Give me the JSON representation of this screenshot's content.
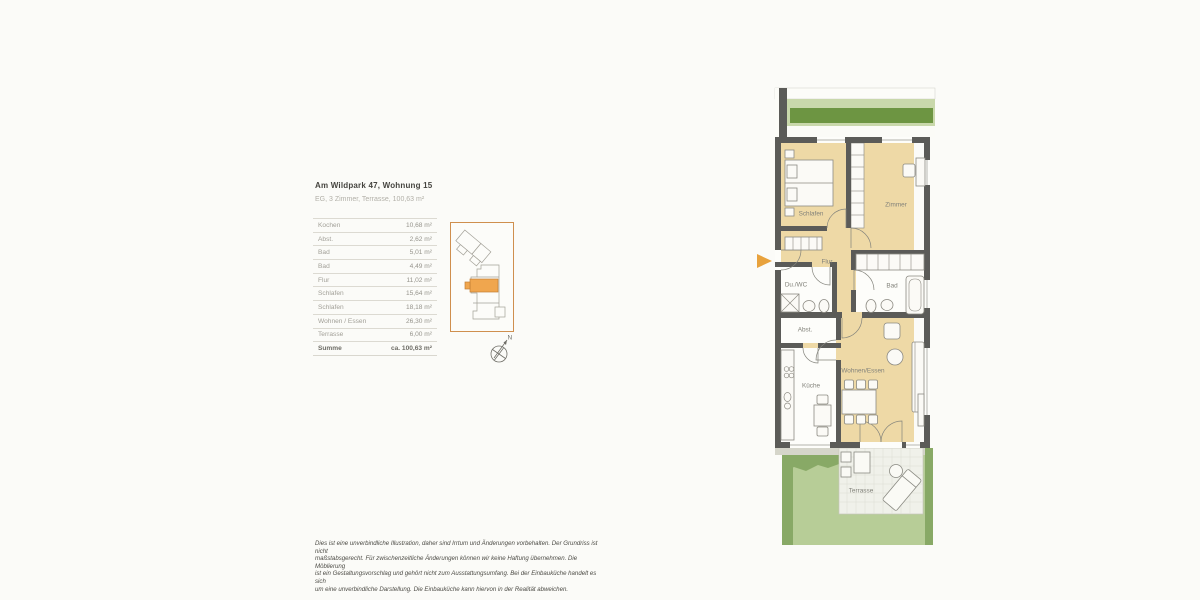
{
  "header": {
    "title": "Am Wildpark 47, Wohnung 15",
    "subtitle": "EG, 3 Zimmer, Terrasse, 100,63 m²"
  },
  "area_table": {
    "rows": [
      {
        "label": "Kochen",
        "value": "10,68 m²",
        "bold": false
      },
      {
        "label": "Abst.",
        "value": "2,62 m²",
        "bold": false
      },
      {
        "label": "Bad",
        "value": "5,01 m²",
        "bold": false
      },
      {
        "label": "Bad",
        "value": "4,49 m²",
        "bold": false
      },
      {
        "label": "Flur",
        "value": "11,02 m²",
        "bold": false
      },
      {
        "label": "Schlafen",
        "value": "15,64 m²",
        "bold": false
      },
      {
        "label": "Schlafen",
        "value": "18,18 m²",
        "bold": false
      },
      {
        "label": "Wohnen / Essen",
        "value": "26,30 m²",
        "bold": false
      },
      {
        "label": "Terrasse",
        "value": "6,00 m²",
        "bold": false
      },
      {
        "label": "Summe",
        "value": "ca. 100,63 m²",
        "bold": true
      }
    ]
  },
  "site_plan": {
    "compass_label": "N",
    "highlight_color": "#f0a64e"
  },
  "floor_plan": {
    "rooms": {
      "schlafen": "Schlafen",
      "zimmer": "Zimmer",
      "flur": "Flur",
      "du_wc": "Du./WC",
      "bad": "Bad",
      "abst": "Abst.",
      "kueche": "Küche",
      "wohnen_essen": "Wohnen/Essen",
      "terrasse": "Terrasse"
    },
    "colors": {
      "wood_floor": "#eed9a6",
      "wall": "#5b5b58",
      "garden_light": "#b7cd97",
      "garden_dark": "#88a966",
      "hedge": "#6d9542",
      "terrace": "#f0f1ea",
      "entrance_arrow": "#e8a23d"
    }
  },
  "disclaimer": {
    "lines": [
      "Dies ist eine unverbindliche Illustration, daher sind Irrtum und Änderungen vorbehalten. Der Grundriss ist nicht",
      "maßstabsgerecht. Für zwischenzeitliche Änderungen können wir keine Haftung übernehmen. Die Möblierung",
      "ist ein Gestaltungsvorschlag und gehört nicht zum Ausstattungsumfang. Bei der Einbauküche handelt es sich",
      "um eine unverbindliche Darstellung. Die Einbauküche kann hiervon in der Realität abweichen."
    ]
  }
}
